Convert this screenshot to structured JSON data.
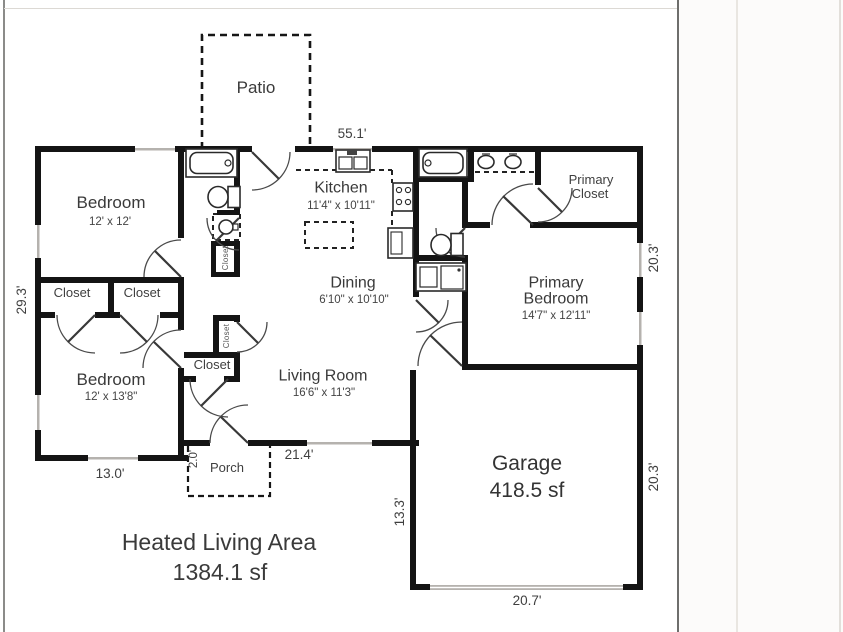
{
  "plan": {
    "rooms": {
      "patio": {
        "label": "Patio"
      },
      "bedroom1": {
        "label": "Bedroom",
        "dims": "12' x 12'"
      },
      "kitchen": {
        "label": "Kitchen",
        "dims": "11'4\" x 10'11\""
      },
      "primary_closet": {
        "line1": "Primary",
        "line2": "Closet"
      },
      "dining": {
        "label": "Dining",
        "dims": "6'10\" x 10'10\""
      },
      "primary_bedroom": {
        "line1": "Primary",
        "line2": "Bedroom",
        "dims": "14'7\" x 12'11\""
      },
      "closet_left1": {
        "label": "Closet"
      },
      "closet_left2": {
        "label": "Closet"
      },
      "closet_bath": {
        "label": "Closet"
      },
      "closet_hall": {
        "label": "Closet"
      },
      "closet_mid": {
        "label": "Closet"
      },
      "bedroom2": {
        "label": "Bedroom",
        "dims": "12' x 13'8\""
      },
      "living_room": {
        "label": "Living Room",
        "dims": "16'6\" x 11'3\""
      },
      "garage": {
        "label": "Garage",
        "area": "418.5 sf"
      },
      "porch": {
        "label": "Porch"
      }
    },
    "dimensions": {
      "top": "55.1'",
      "left": "29.3'",
      "right_upper": "20.3'",
      "right_garage": "20.3'",
      "bottom_left": "13.0'",
      "porch_depth": "2.0'",
      "living_bottom": "21.4'",
      "garage_left": "13.3'",
      "garage_bottom": "20.7'"
    },
    "summary": {
      "title": "Heated Living Area",
      "area": "1384.1 sf"
    },
    "colors": {
      "wall": "#141414",
      "window": "#b5b2ae",
      "text": "#3a3a3a",
      "background": "#ffffff"
    }
  }
}
